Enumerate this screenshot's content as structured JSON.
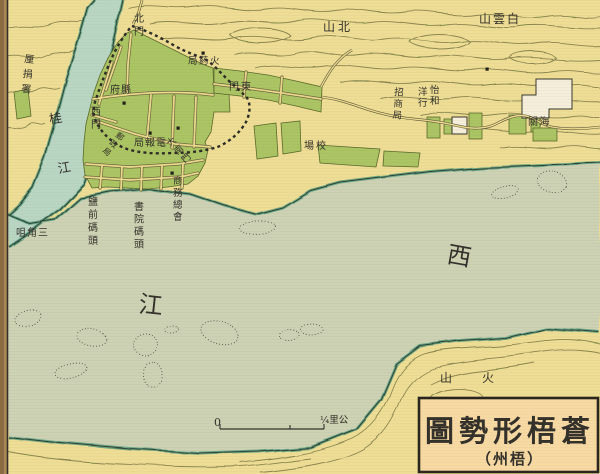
{
  "map": {
    "description": "historical-city-map",
    "title_box": {
      "title": "圖勢形梧蒼",
      "subtitle": "（州梧）"
    },
    "scale_bar": {
      "zero_label": "0",
      "unit_label": "¼里公"
    },
    "colors": {
      "land": "#eedd95",
      "water_main_river": "#cdd2b4",
      "water_gui_river": "#b9d6c3",
      "city_block_green": "#abc464",
      "shoreline_teal": "#5a9c7e",
      "ink": "#33312a",
      "contour": "#8b8750",
      "street_yellow": "#ecd98e",
      "title_box_bg": "#f7d9a4"
    },
    "labels": [
      {
        "name": "likin-office-label",
        "text": "厘捐署",
        "x": 24,
        "y": 62,
        "mode": "v",
        "gap": 15,
        "size": 10,
        "rotate": 6
      },
      {
        "name": "gui-river-label",
        "text": "桂江",
        "x": 50,
        "y": 124,
        "mode": "v",
        "gap": 50,
        "size": 13,
        "rotate": -10
      },
      {
        "name": "north-gate-label",
        "text": "北門",
        "x": 134,
        "y": 22,
        "mode": "v",
        "gap": 13,
        "size": 10,
        "rotate": 0
      },
      {
        "name": "powder-bureau-label",
        "text": "局葯火",
        "x": 188,
        "y": 64,
        "mode": "h",
        "size": 9.5,
        "ls": 1.5
      },
      {
        "name": "east-gate-label",
        "text": "門東",
        "x": 229,
        "y": 90,
        "mode": "h",
        "size": 10,
        "ls": 2
      },
      {
        "name": "county-office-label",
        "text": "府縣",
        "x": 110,
        "y": 93,
        "mode": "h",
        "size": 10,
        "ls": 1
      },
      {
        "name": "west-gate-label",
        "text": "西門",
        "x": 91,
        "y": 115,
        "mode": "v",
        "gap": 13,
        "size": 10,
        "rotate": 0
      },
      {
        "name": "post-office-label",
        "text": "郵政局",
        "x": 115,
        "y": 136,
        "mode": "v",
        "gap": 10,
        "size": 8,
        "rotate": 40
      },
      {
        "name": "telegraph-office-label",
        "text": "局報電",
        "x": 134,
        "y": 146,
        "mode": "h",
        "size": 10,
        "ls": 1
      },
      {
        "name": "south-gate-label",
        "text": "大南門",
        "x": 170,
        "y": 147,
        "mode": "v",
        "gap": 11,
        "size": 9,
        "rotate": -42
      },
      {
        "name": "chamber-of-commerce-label",
        "text": "商務總會",
        "x": 173,
        "y": 184,
        "mode": "v",
        "gap": 12,
        "size": 9.5,
        "rotate": 0
      },
      {
        "name": "academy-wharf-label",
        "text": "書院碼頭",
        "x": 134,
        "y": 210,
        "mode": "v",
        "gap": 12.5,
        "size": 10,
        "rotate": 0
      },
      {
        "name": "salt-front-wharf-label",
        "text": "鹽前碼頭",
        "x": 88,
        "y": 205,
        "mode": "v",
        "gap": 13,
        "size": 10,
        "rotate": 0
      },
      {
        "name": "sanjiao-point-label",
        "text": "咀角三",
        "x": 16,
        "y": 236,
        "mode": "h",
        "size": 10,
        "ls": 1
      },
      {
        "name": "drill-ground-label",
        "text": "場校",
        "x": 304,
        "y": 149,
        "mode": "h",
        "size": 10,
        "ls": 2
      },
      {
        "name": "merchants-bureau-label",
        "text": "招商局",
        "x": 394,
        "y": 95,
        "mode": "v",
        "gap": 11.5,
        "size": 9.5,
        "rotate": 4
      },
      {
        "name": "jardine-name-label",
        "text": "怡和",
        "x": 430,
        "y": 93,
        "mode": "v",
        "gap": 11,
        "size": 9.5,
        "rotate": 0
      },
      {
        "name": "jardine-hong-label",
        "text": "洋行",
        "x": 418,
        "y": 95,
        "mode": "v",
        "gap": 11,
        "size": 9.5,
        "rotate": 0
      },
      {
        "name": "customs-label",
        "text": "關海",
        "x": 528,
        "y": 125,
        "mode": "h",
        "size": 10,
        "ls": 1.5
      },
      {
        "name": "north-mountain-label",
        "text": "山北",
        "x": 323,
        "y": 31,
        "mode": "h",
        "size": 12,
        "ls": 3
      },
      {
        "name": "baiyun-mountain-label",
        "text": "山雲白",
        "x": 479,
        "y": 23,
        "mode": "h",
        "size": 12,
        "ls": 2
      },
      {
        "name": "xi-river-char-west",
        "text": "西",
        "x": 446,
        "y": 262,
        "mode": "h",
        "size": 24,
        "rotate": 10
      },
      {
        "name": "xi-river-char-jiang",
        "text": "江",
        "x": 138,
        "y": 312,
        "mode": "h",
        "size": 24,
        "rotate": 6
      },
      {
        "name": "volcano-label",
        "text": "山火",
        "x": 440,
        "y": 382,
        "mode": "h",
        "size": 12,
        "ls": 30
      }
    ]
  }
}
